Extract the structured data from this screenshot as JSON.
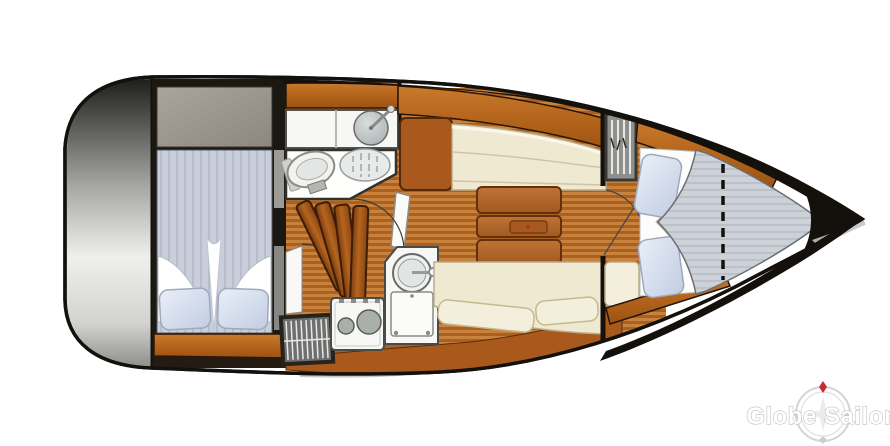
{
  "watermark": {
    "brand": "Globe Sailor"
  },
  "icons": {
    "compass_rose_icon": "circular compass ring with red north diamond marker"
  },
  "colors": {
    "hull_outline": "#14110d",
    "deck_white": "#ffffff",
    "rub_rail": "#c8c8c8",
    "transom_dark": "#1e1e1c",
    "transom_mid": "#a9a9a7",
    "transom_light": "#efefed",
    "transom_low": "#8e8e8c",
    "cabin_bg": "#1b1711",
    "cabinet_taupe_hi": "#aaa49d",
    "cabinet_taupe_lo": "#8d8780",
    "mattress_blue": "#c9cedb",
    "mattress_stripe": "#b7bdcc",
    "bow_mattress": "#cdd1d8",
    "bow_stripe": "#bcc1c9",
    "pillow_hi": "#e9eff8",
    "pillow_lo": "#c2cde2",
    "pillow_edge": "#9fa9bd",
    "bedding_white": "#fdfdfb",
    "wood_hi": "#c97a2c",
    "wood_mid": "#b4651c",
    "wood_lo": "#9c5212",
    "wood_edge": "#2c1505",
    "hull_shelf_brown": "#a8591b",
    "hull_shelf_edge": "#5c2d0a",
    "floor_light": "#c9823b",
    "floor_dark": "#aa5f23",
    "table_hi": "#c07336",
    "table_lo": "#a05a20",
    "table_edge": "#63300b",
    "settee_cream": "#efe9d2",
    "settee_edge": "#b9ae8a",
    "cushion_cream": "#f4efdc",
    "fixture_white": "#f7f7f5",
    "fixture_stroke": "#55524e",
    "metal_gray_hi": "#d8dcdc",
    "metal_gray_lo": "#aab2b2",
    "burner_gray": "#a9b0ac",
    "grate_fill": "#e8eaea",
    "grate_line": "#9aa4a4",
    "louver_gray": "#8f8f8d",
    "louver_frame": "#3a3835",
    "step_dark": "#7a3a0e",
    "step_mid": "#b5651f",
    "gray_sliver": "#9b9b97",
    "bow_gray_wedge": "#a9aeb2",
    "logo_ring": "#d4d4d4",
    "logo_red": "#cc2a33",
    "logo_text": "#ffffff",
    "logo_outline": "#c2c2c2"
  }
}
